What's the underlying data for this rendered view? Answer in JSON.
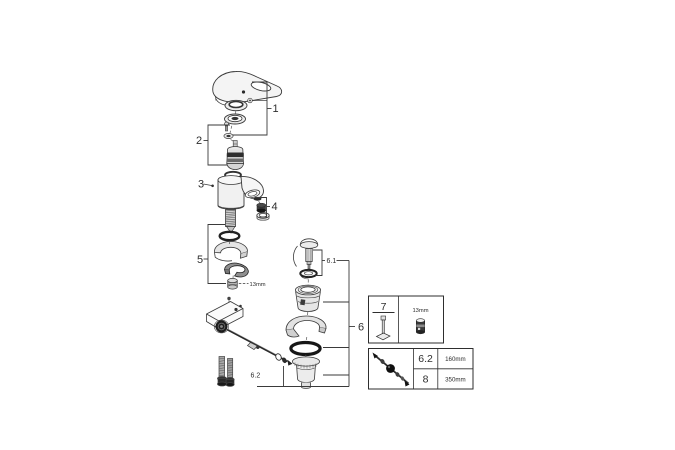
{
  "page": {
    "background": "#ffffff",
    "line_color": "#3a3a3a"
  },
  "callouts": {
    "part1": "1",
    "part2": "2",
    "part3": "3",
    "part4": "4",
    "part5": "5",
    "part6": "6",
    "part6_1": "6.1",
    "part6_2": "6.2"
  },
  "annotations": {
    "mounting_nut_wrench_size": "13mm"
  },
  "tool_box": {
    "part_number": "7",
    "socket_size": "13mm"
  },
  "size_table": {
    "rows": [
      {
        "part": "6.2",
        "length": "160mm"
      },
      {
        "part": "8",
        "length": "350mm"
      }
    ]
  }
}
